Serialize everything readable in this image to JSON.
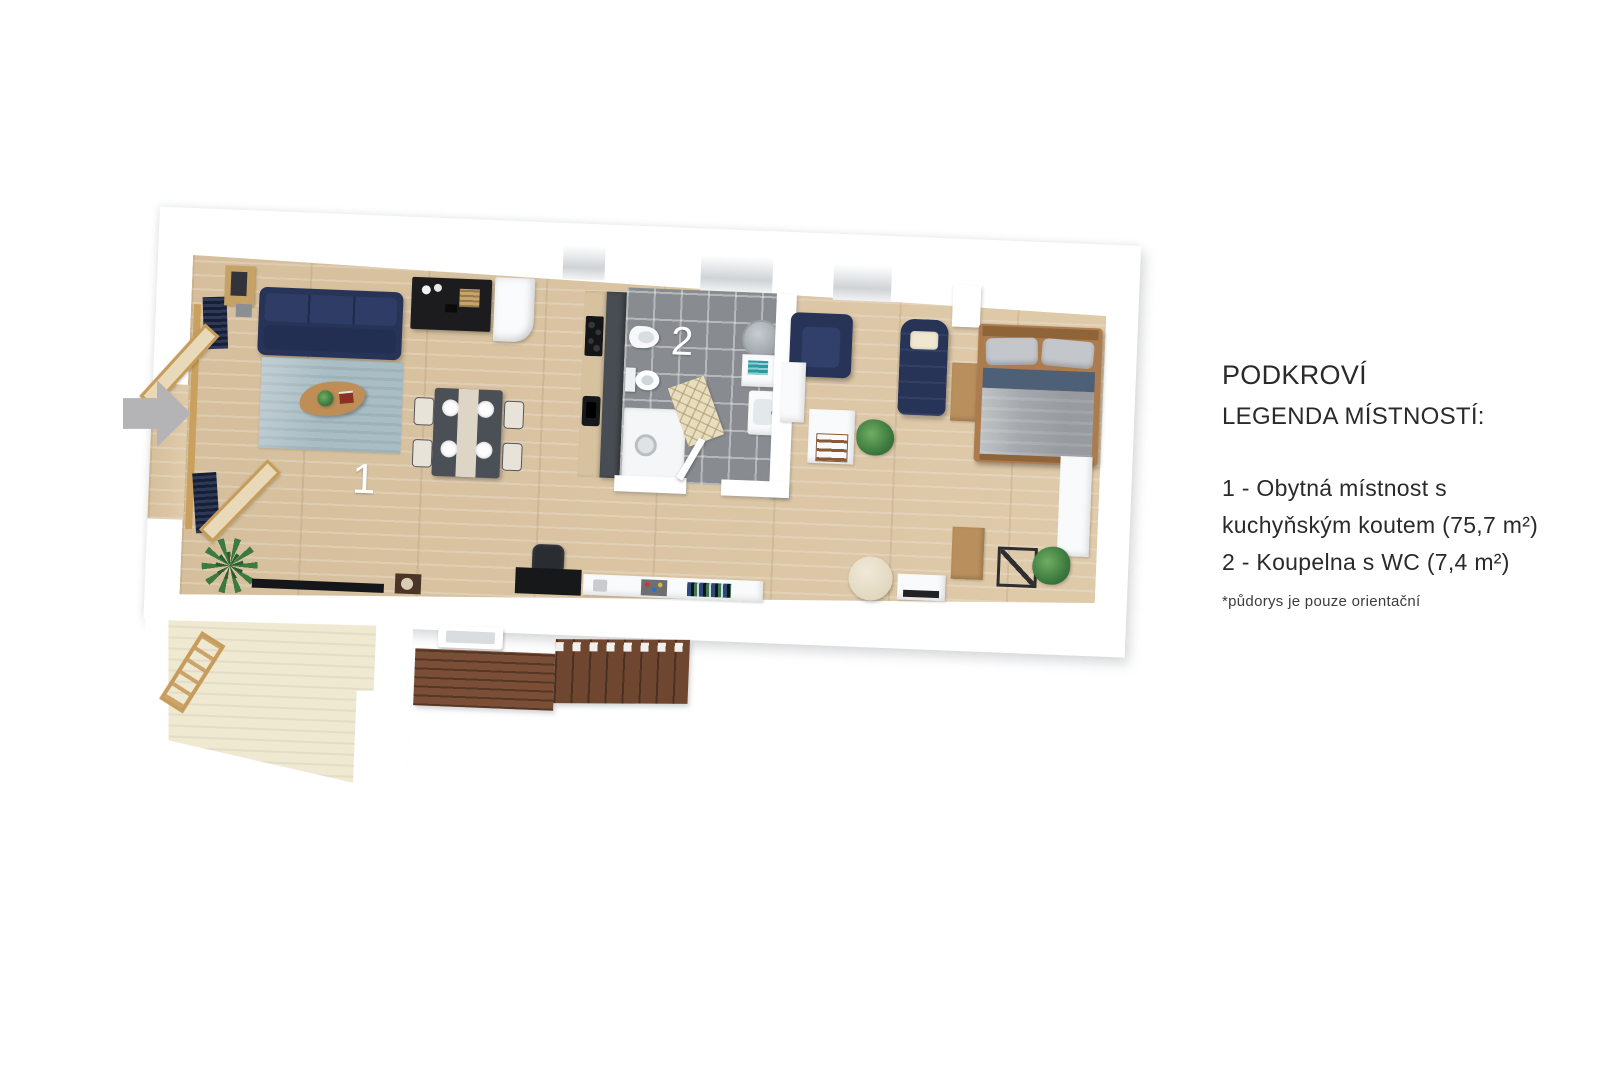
{
  "legend": {
    "title": "PODKROVÍ",
    "subtitle": "LEGENDA MÍSTNOSTÍ:",
    "lines": [
      "1 - Obytná místnost s",
      "kuchyňským koutem (75,7 m²)",
      "2 - Koupelna s WC (7,4 m²)"
    ],
    "note": "*půdorys je pouze orientační"
  },
  "rooms": [
    {
      "label": "1",
      "name": "Obytná místnost s kuchyňským koutem",
      "area": "75,7 m²"
    },
    {
      "label": "2",
      "name": "Koupelna s WC",
      "area": "7,4 m²"
    }
  ],
  "plan_labels": {
    "room1": "1",
    "room2": "2"
  },
  "colors": {
    "sofa_navy": "#273458",
    "floor_wood": "#dcc7a6",
    "bathroom_tile": "#888c90",
    "rug_blue": "#a9bdc4",
    "terrace_cream": "#efe9d2",
    "deck_brown": "#7b4f37",
    "arrow_gray": "#b4b4b6",
    "legend_text": "#2a2a2a"
  }
}
